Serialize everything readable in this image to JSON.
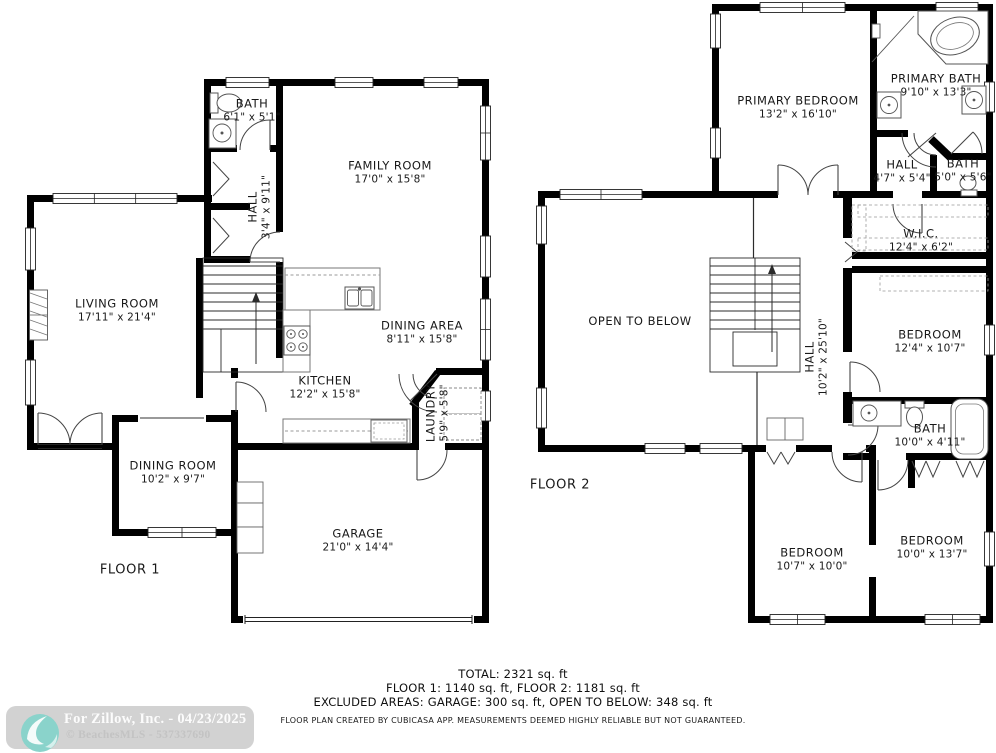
{
  "colors": {
    "wall": "#000000",
    "line": "#333333",
    "background": "#ffffff",
    "watermark_pill": "#d2d2d2",
    "watermark_teal": "#8ad3cb"
  },
  "icons": [
    "toilet-icon",
    "sink-icon",
    "bathtub-icon",
    "corner-tub-icon",
    "stove-icon",
    "dishwasher-icon",
    "washer-dryer-icon",
    "fireplace-icon",
    "stairs-icon",
    "door-arc-icon",
    "window-icon",
    "wave-logo-icon"
  ],
  "floor1": {
    "label": "FLOOR 1",
    "rooms": {
      "bath": {
        "name": "BATH",
        "dims": "6'1\" x 5'1\""
      },
      "hall": {
        "name": "HALL",
        "dims": "3'4\" x 9'11\""
      },
      "family_room": {
        "name": "FAMILY ROOM",
        "dims": "17'0\" x 15'8\""
      },
      "living_room": {
        "name": "LIVING ROOM",
        "dims": "17'11\" x 21'4\""
      },
      "dining_area": {
        "name": "DINING AREA",
        "dims": "8'11\" x 15'8\""
      },
      "kitchen": {
        "name": "KITCHEN",
        "dims": "12'2\" x 15'8\""
      },
      "laundry": {
        "name": "LAUNDRY",
        "dims": "5'9\" x 5'8\""
      },
      "dining_room": {
        "name": "DINING ROOM",
        "dims": "10'2\" x 9'7\""
      },
      "garage": {
        "name": "GARAGE",
        "dims": "21'0\" x 14'4\""
      }
    }
  },
  "floor2": {
    "label": "FLOOR 2",
    "rooms": {
      "primary_bedroom": {
        "name": "PRIMARY BEDROOM",
        "dims": "13'2\" x 16'10\""
      },
      "primary_bath": {
        "name": "PRIMARY BATH",
        "dims": "9'10\" x 13'3\""
      },
      "hall_upper": {
        "name": "HALL",
        "dims": "4'7\" x 5'4\""
      },
      "bath_upper": {
        "name": "BATH",
        "dims": "5'0\" x 5'6\""
      },
      "wic": {
        "name": "W.I.C.",
        "dims": "12'4\" x 6'2\""
      },
      "open_to_below": {
        "name": "OPEN TO BELOW",
        "dims": ""
      },
      "hall": {
        "name": "HALL",
        "dims": "10'2\" x 25'10\""
      },
      "bedroom_mid": {
        "name": "BEDROOM",
        "dims": "12'4\" x 10'7\""
      },
      "bath_lower": {
        "name": "BATH",
        "dims": "10'0\" x 4'11\""
      },
      "bedroom_bl": {
        "name": "BEDROOM",
        "dims": "10'7\" x 10'0\""
      },
      "bedroom_br": {
        "name": "BEDROOM",
        "dims": "10'0\" x 13'7\""
      }
    }
  },
  "footer": {
    "total": "TOTAL: 2321 sq. ft",
    "floors": "FLOOR 1: 1140 sq. ft, FLOOR 2: 1181 sq. ft",
    "excluded": "EXCLUDED AREAS: GARAGE: 300 sq. ft, OPEN TO BELOW: 348 sq. ft",
    "disclaimer": "FLOOR PLAN CREATED BY CUBICASA APP. MEASUREMENTS DEEMED HIGHLY RELIABLE BUT NOT GUARANTEED."
  },
  "watermark": {
    "line1": "For Zillow, Inc. - 04/23/2025",
    "line2": "© BeachesMLS - 537337690"
  }
}
